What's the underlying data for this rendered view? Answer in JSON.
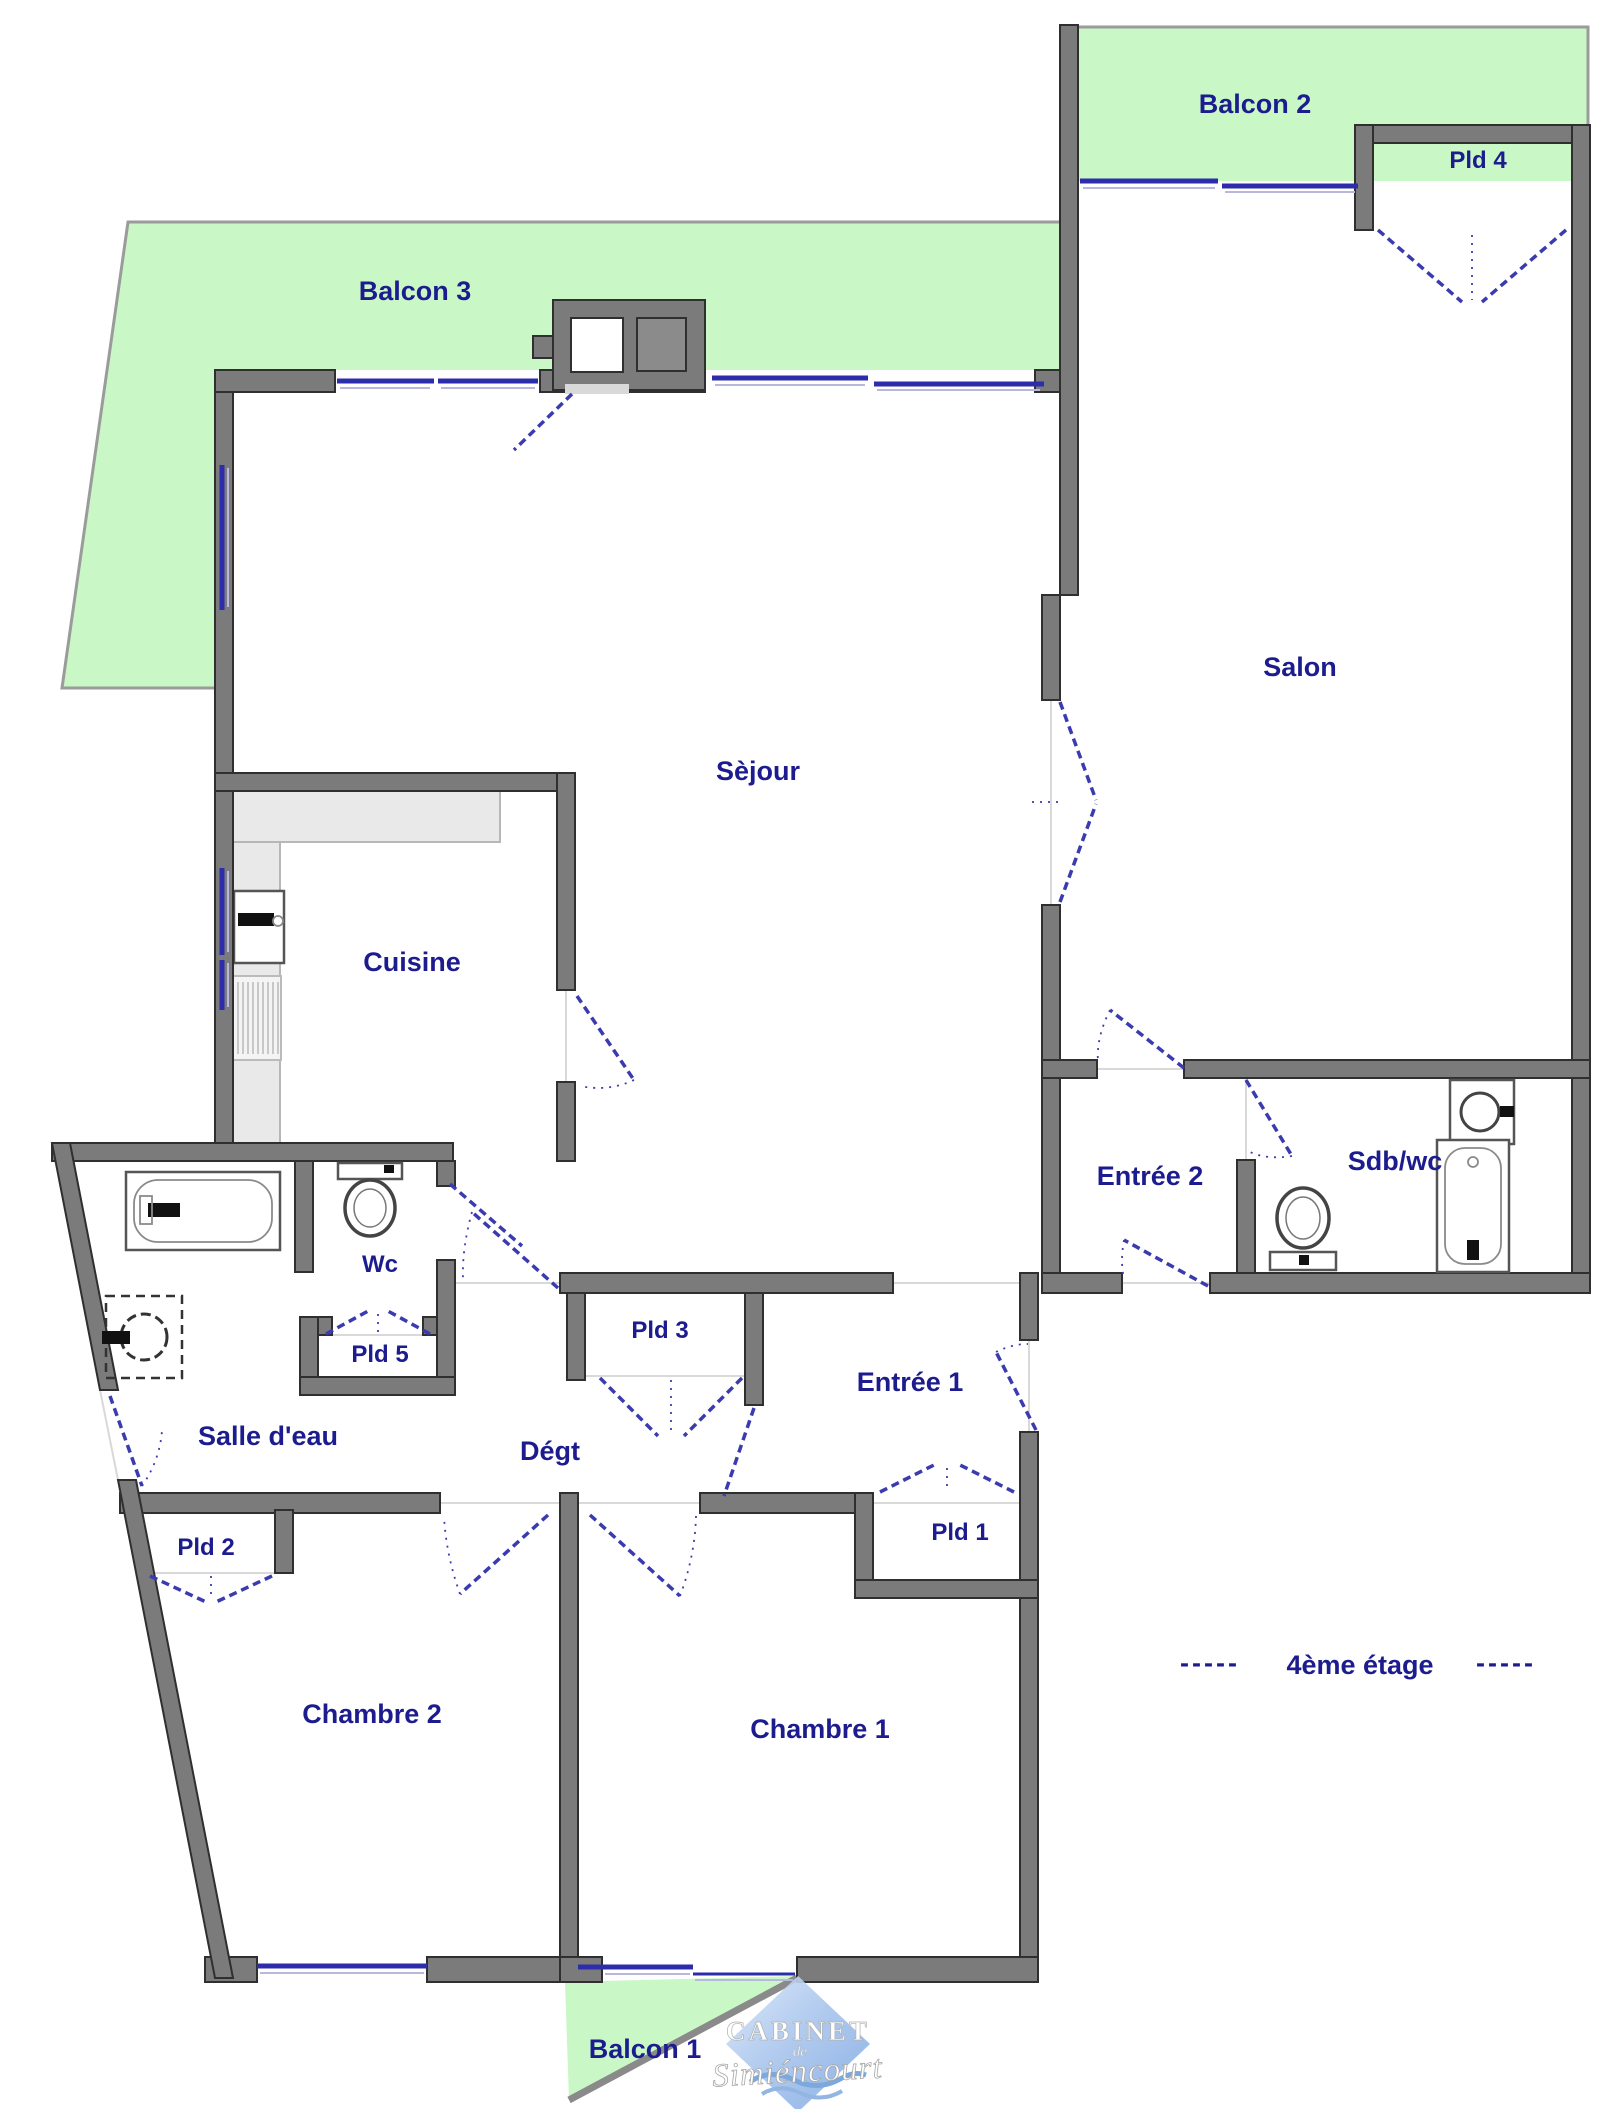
{
  "floor_plan": {
    "labels": {
      "balcon1": "Balcon 1",
      "balcon2": "Balcon 2",
      "balcon3": "Balcon 3",
      "pld1": "Pld 1",
      "pld2": "Pld 2",
      "pld3": "Pld 3",
      "pld4": "Pld 4",
      "pld5": "Pld 5",
      "salon": "Salon",
      "sejour": "Sèjour",
      "cuisine": "Cuisine",
      "entree1": "Entrée 1",
      "entree2": "Entrée 2",
      "sdbwc": "Sdb/wc",
      "wc": "Wc",
      "salledeau": "Salle d'eau",
      "degt": "Dégt",
      "chambre1": "Chambre 1",
      "chambre2": "Chambre 2"
    },
    "floor_label": "4ème étage",
    "floor_dash_left": "-----",
    "floor_dash_right": "-----",
    "logo": {
      "top": "CABINET",
      "mid": "de",
      "bottom": "Simiéncourt"
    }
  },
  "colors": {
    "wall": "#7b7b7b",
    "wall_outline": "#2f2f2f",
    "balcony": "#c9f7c6",
    "window": "#2d2dab",
    "door": "#3b3bb0",
    "label": "#1c1c8e",
    "counter": "#e9e9e9",
    "fixture": "#555555",
    "logo_blue": "#9cbce8"
  }
}
